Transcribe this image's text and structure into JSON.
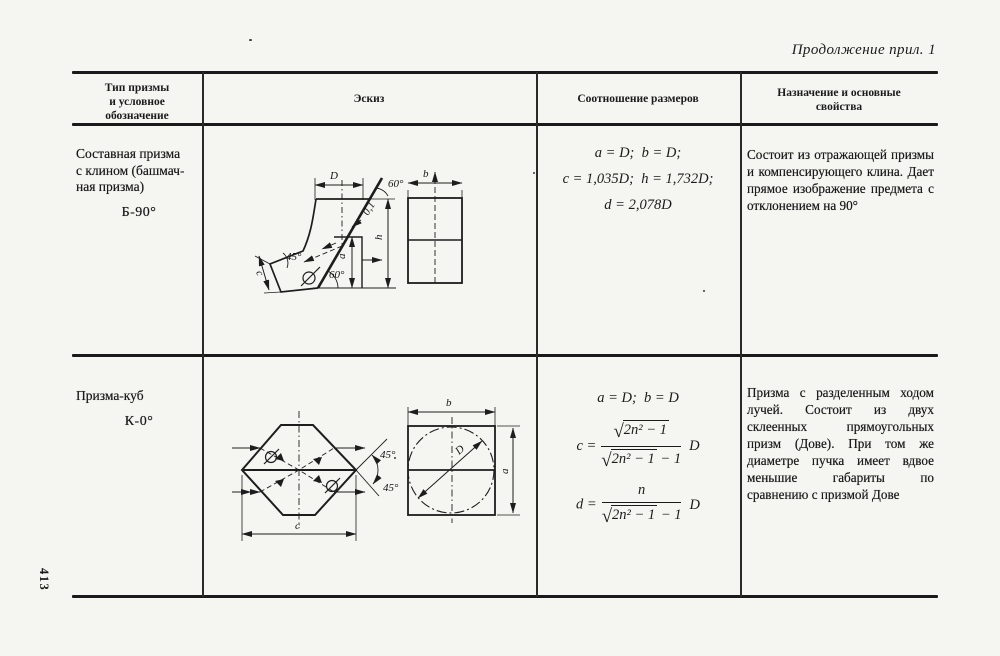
{
  "page": {
    "caption": "Продолжение прил. 1",
    "page_number": "413"
  },
  "table": {
    "headers": {
      "col1": [
        "Тип призмы",
        "и условное",
        "обозначение"
      ],
      "col2": "Эскиз",
      "col3": "Соотношение размеров",
      "col4": [
        "Назначение и основные",
        "свойства"
      ]
    },
    "rows": [
      {
        "type_lines": [
          "Составная призма",
          "с клином (башмач-",
          "ная призма)"
        ],
        "designation": "Б-90°",
        "formulas": [
          "a = D;  b = D;",
          "c = 1,035D;  h = 1,732D;",
          "d = 2,078D"
        ],
        "description": "Состоит из отражающей призмы и компенсирующего клина. Дает прямое изображение предмета с отклонением на 90°",
        "sketch_labels": {
          "D": "D",
          "b": "b",
          "h": "h",
          "a": "a",
          "c": "c",
          "angle_top": "60°",
          "angle_bottom": "60°",
          "angle_left": "45°",
          "gap": "0,1"
        }
      },
      {
        "type_lines": [
          "Призма-куб"
        ],
        "designation": "К-0°",
        "formula_line1": "a = D;  b = D",
        "radical": "√",
        "frac_c": {
          "lhs": "c =",
          "num_rad": "2n² − 1",
          "den_rad": "2n² − 1",
          "den_tail": "− 1",
          "mult": "D"
        },
        "frac_d": {
          "lhs": "d =",
          "num": "n",
          "den_rad": "2n² − 1",
          "den_tail": "− 1",
          "mult": "D"
        },
        "description": "Призма с разделенным ходом лучей. Состоит из двух склеенных прямоугольных призм (Дове). При том же диаметре пучка имеет вдвое меньшие габариты по сравнению с призмой Дове",
        "sketch_labels": {
          "angle1": "45°",
          "angle2": "45°",
          "c": "c",
          "b": "b",
          "D": "D",
          "a": "a"
        }
      }
    ]
  }
}
